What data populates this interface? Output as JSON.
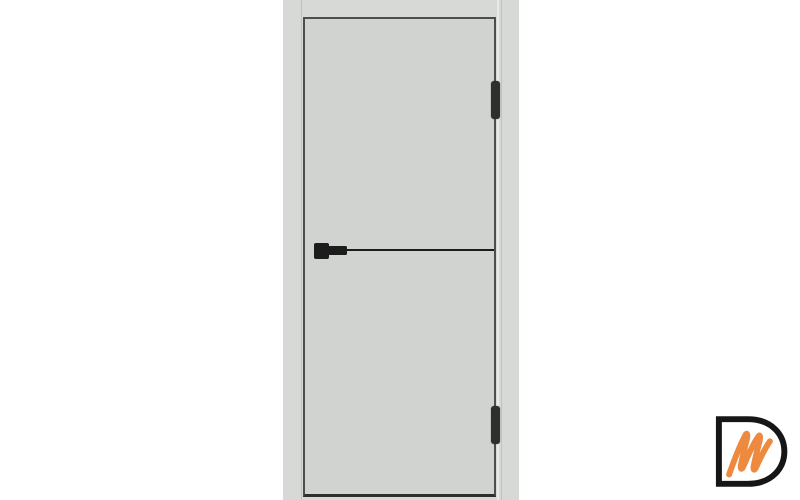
{
  "scene": {
    "colors": {
      "bg": "#ffffff",
      "frame": "#d7d9d6",
      "leaf": "#d1d3d0",
      "leaf-edge": "#4b4e4b",
      "leaf-bottom": "#2d2f2d",
      "hardware": "#1c1c1c",
      "hinge": "#2c2f2c",
      "logo-d": "#161616",
      "logo-m": "#ee8a3f"
    },
    "door": {
      "visible_hinges": 2,
      "molding": "black horizontal edge strip at handle height",
      "handle_side": "left"
    },
    "watermark": {
      "letters": "Dm",
      "outline_letter": "D",
      "script_letter": "m",
      "label": "Dm logo watermark"
    }
  }
}
